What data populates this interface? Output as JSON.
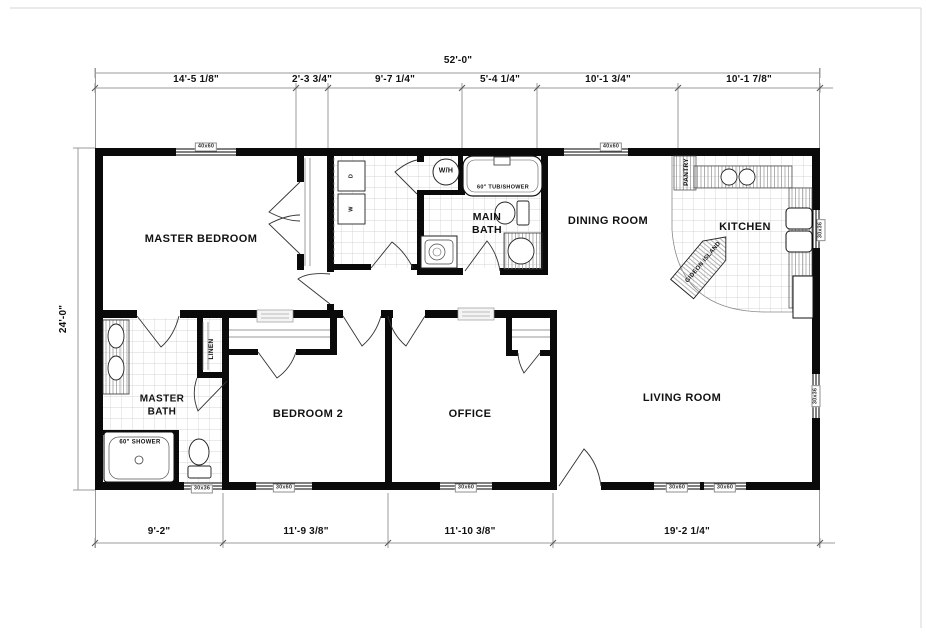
{
  "dimensions": {
    "overall_width": "52'-0\"",
    "overall_height": "24'-0\"",
    "top_segments": [
      "14'-5 1/8\"",
      "2'-3 3/4\"",
      "9'-7 1/4\"",
      "5'-4 1/4\"",
      "10'-1 3/4\"",
      "10'-1 7/8\""
    ],
    "bottom_segments": [
      "9'-2\"",
      "11'-9 3/8\"",
      "11'-10 3/8\"",
      "19'-2 1/4\""
    ]
  },
  "rooms": {
    "master_bedroom": "MASTER BEDROOM",
    "main_bath": "MAIN BATH",
    "dining_room": "DINING ROOM",
    "kitchen": "KITCHEN",
    "living_room": "LIVING ROOM",
    "bedroom_2": "BEDROOM 2",
    "office": "OFFICE",
    "master_bath": "MASTER BATH",
    "pantry": "PANTRY",
    "linen": "LINEN"
  },
  "fixtures": {
    "water_heater": "W/H",
    "tub_shower": "60\" TUB/SHOWER",
    "shower": "60\" SHOWER",
    "island": "GIDEON ISLAND",
    "dryer": "D",
    "washer": "W"
  },
  "window_labels": {
    "top_master": "40x60",
    "top_dining": "40x60",
    "bottom_master_bath": "30x36",
    "bottom_bedroom2": "30x60",
    "bottom_office": "30x60",
    "bottom_living_1": "30x60",
    "bottom_living_2": "30x60",
    "right_kitchen": "30x36",
    "right_living": "30x36"
  }
}
